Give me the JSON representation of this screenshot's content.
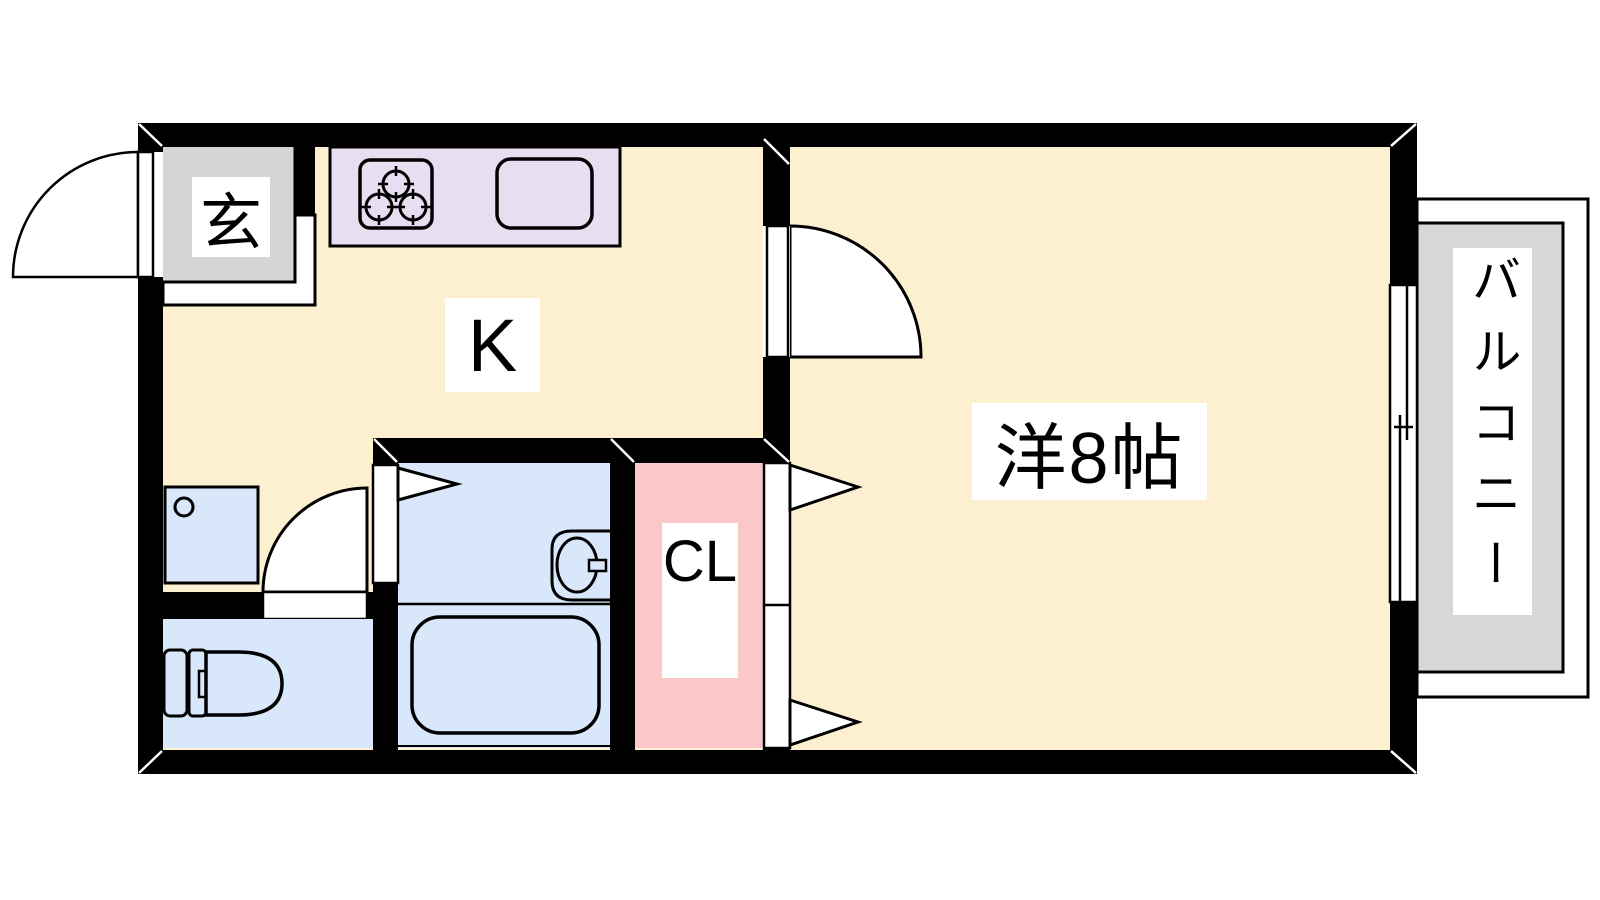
{
  "floor_plan": {
    "rooms": {
      "entrance": {
        "label": "玄"
      },
      "kitchen": {
        "label": "K"
      },
      "western_room": {
        "label": "洋8帖"
      },
      "closet": {
        "label": "CL"
      },
      "balcony": {
        "label": "バルコニー"
      }
    },
    "fixtures": [
      "entrance-swing-door",
      "gas-stove-3-burner",
      "kitchen-sink",
      "room-swing-door",
      "closet-double-doors",
      "bathroom-door",
      "bathtub",
      "bathroom-sink",
      "toilet",
      "washbasin",
      "toilet-swing-door",
      "sliding-window"
    ],
    "colors": {
      "wall": "#000000",
      "floor_cream": "#FDF0D1",
      "counter_lavender": "#E8DEF1",
      "entrance_gray": "#D5D5D5",
      "balcony_gray": "#D7D7D7",
      "wet_area_blue": "#D9E7FB",
      "closet_pink": "#FAC8C8",
      "white": "#FFFFFF"
    }
  }
}
